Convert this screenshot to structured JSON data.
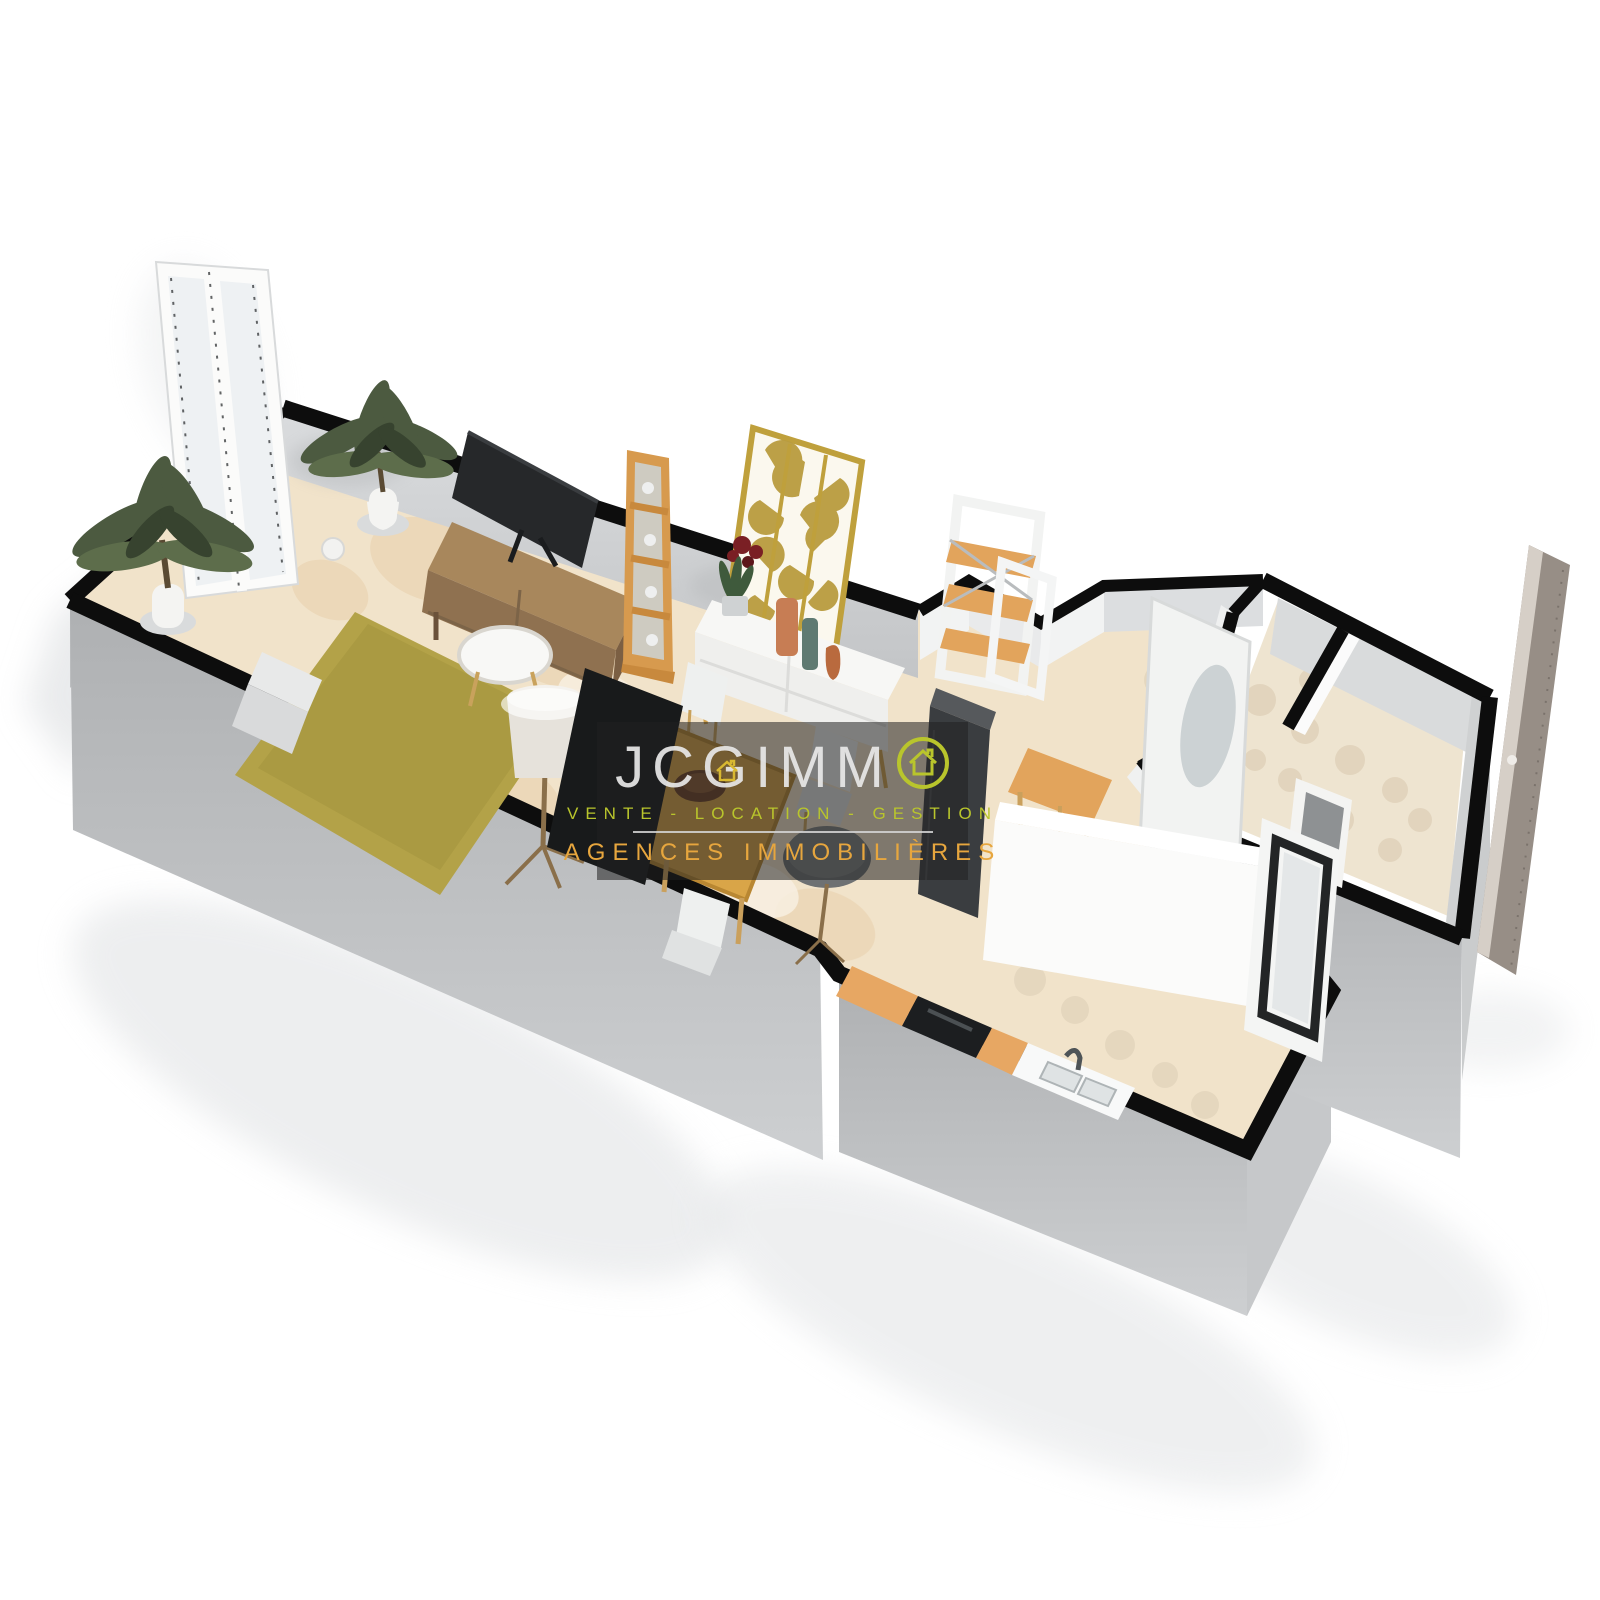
{
  "page": {
    "background": "#ffffff",
    "width": 1600,
    "height": 1600,
    "content": "3D perspective floor plan rendering of a one-bedroom apartment, white background, agency watermark in center"
  },
  "watermark": {
    "brand_prefix": "JC",
    "brand_g": "G",
    "brand_mid": "IMM",
    "brand_full": "JCGIMMO",
    "tagline": "VENTE - LOCATION - GESTION",
    "subtitle": "AGENCES IMMOBILIÈRES",
    "colors": {
      "overlay": "rgba(33,33,33,0.55)",
      "brand_text": "#e8e8e8",
      "lime_accent": "#b9c52c",
      "gold_accent": "#e7a63e",
      "divider": "#d7d7d7"
    },
    "icons": [
      "house-in-circle-icon",
      "house-icon"
    ]
  },
  "floor_plan": {
    "style": "3d-isometric-render",
    "rooms": [
      "living-dining-room",
      "kitchen",
      "hallway",
      "bathroom",
      "wc"
    ],
    "furniture": [
      "french-door",
      "potted-plant-left",
      "potted-plant-corner",
      "tv",
      "tv-sideboard",
      "ladder-shelf",
      "gold-leaf-screen",
      "white-console-with-vases",
      "wall-flowers",
      "area-rug",
      "coffee-table",
      "floor-lamp",
      "sofa-bench",
      "decor-sphere",
      "black-wardrobe-panel",
      "dining-table",
      "dining-chairs",
      "fruit-bowl",
      "round-grey-stool",
      "fridge-cabinet",
      "etagere-shelf",
      "wooden-bar-stool",
      "wooden-bench",
      "white-partition",
      "kitchen-counter",
      "oven",
      "kitchen-sink",
      "faucet",
      "mirror-door",
      "interior-door-frame",
      "window-frame",
      "entry-door-panel"
    ],
    "palette": {
      "wall_top": "#0d0d0d",
      "wall_face_outer": "#b7b9bb",
      "wall_face_inner": "#d6d8da",
      "floor_base": "#f1e3ca",
      "floor_pattern": "#e9d1ae",
      "rug": "#b3a248",
      "wood_sideboard": "#a8875c",
      "wood_table": "#d9a548",
      "wood_shelf": "#e2a45c",
      "kitchen_cabinet": "#e7a763",
      "oven_black": "#1c1e20",
      "tv_black": "#26282a",
      "plant_green": "#4c5a40",
      "gold_screen": "#bfa03c",
      "white_furniture": "#f5f5f3",
      "shadow": "#e0e2e4"
    }
  }
}
